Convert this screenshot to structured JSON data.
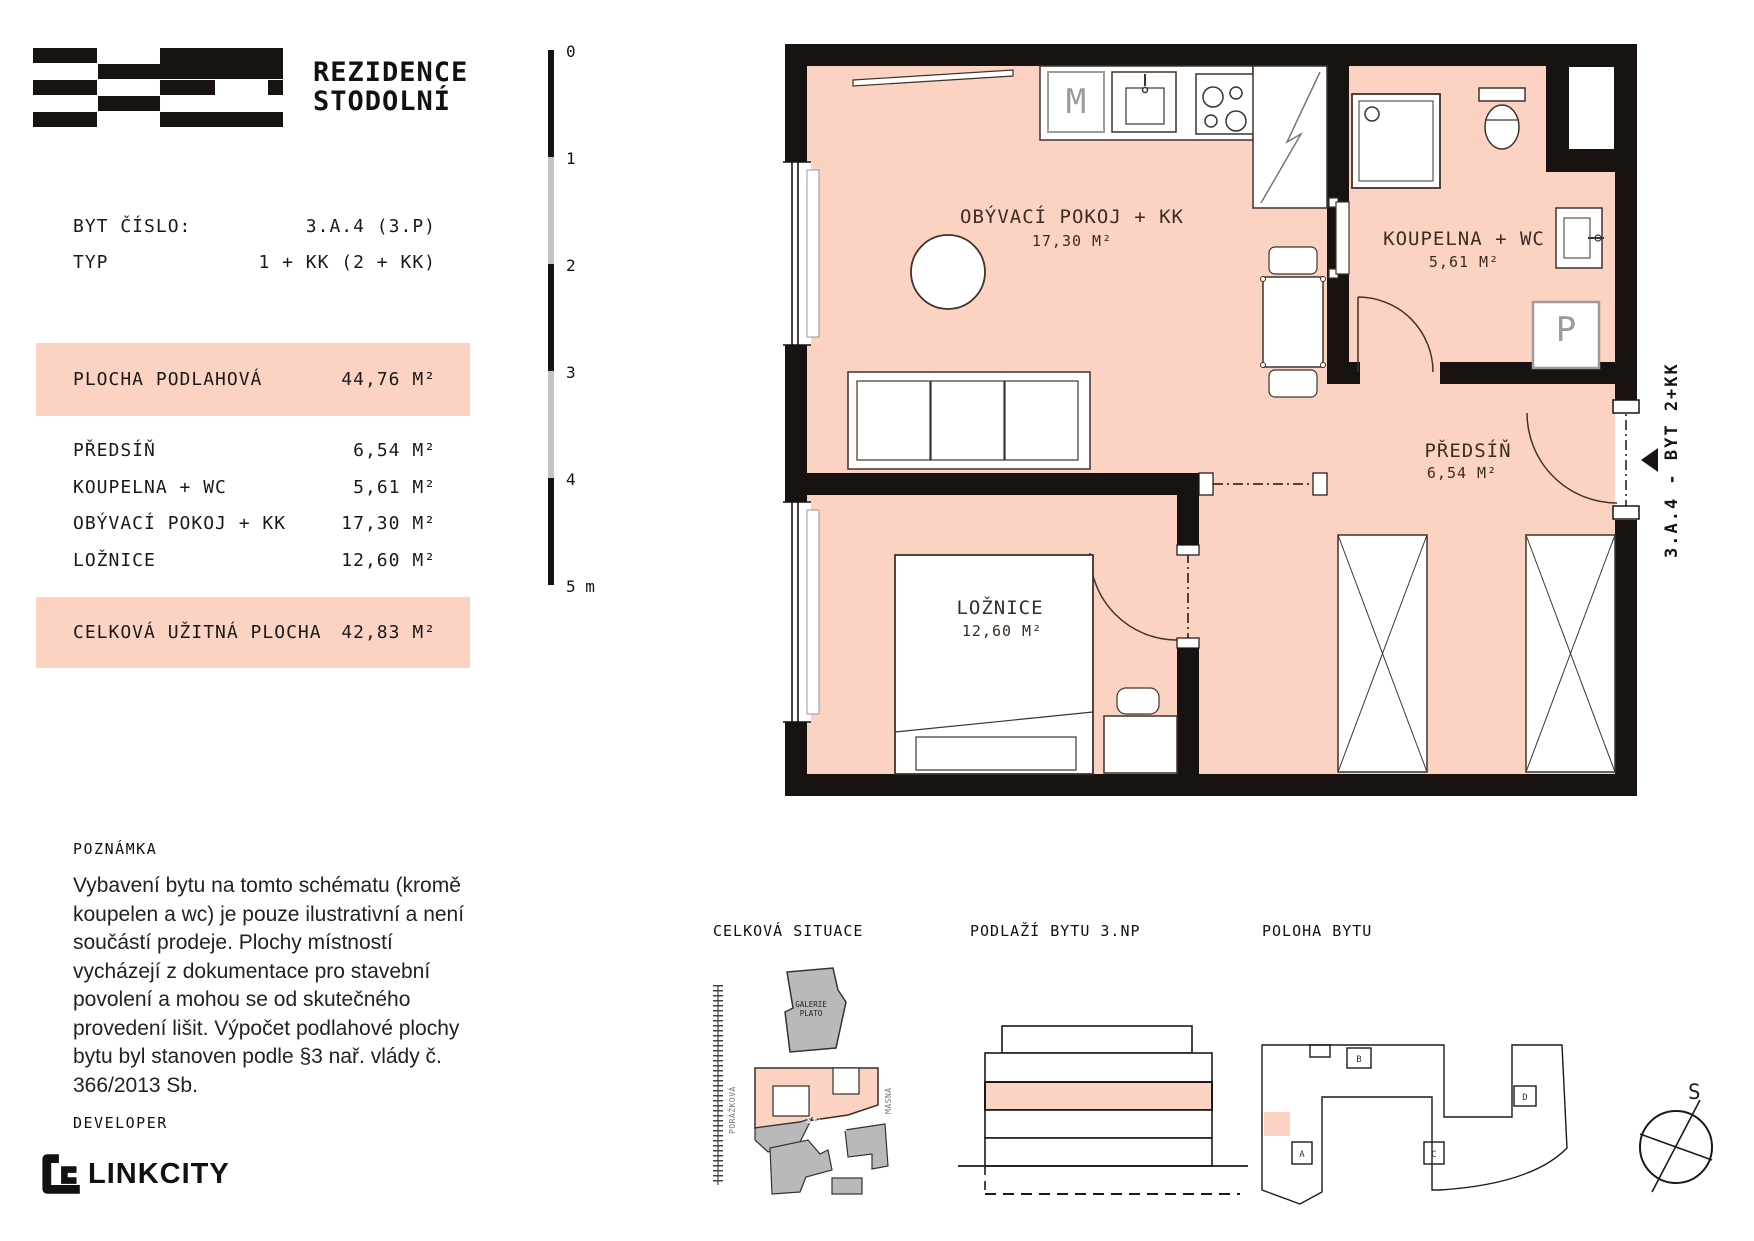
{
  "header": {
    "title_line1": "REZIDENCE",
    "title_line2": "STODOLNÍ"
  },
  "unit_info": {
    "rows": [
      {
        "label": "BYT ČÍSLO:",
        "value": "3.A.4 (3.P)"
      },
      {
        "label": "TYP",
        "value": "1 + KK (2 + KK)"
      }
    ]
  },
  "area_table": {
    "highlight_row": {
      "label": "PLOCHA PODLAHOVÁ",
      "value": "44,76 M²"
    },
    "rows": [
      {
        "label": "PŘEDSÍŇ",
        "value": "6,54 M²"
      },
      {
        "label": "KOUPELNA + WC",
        "value": "5,61 M²"
      },
      {
        "label": "OBÝVACÍ POKOJ + KK",
        "value": "17,30 M²"
      },
      {
        "label": "LOŽNICE",
        "value": "12,60 M²"
      }
    ],
    "total_row": {
      "label": "CELKOVÁ UŽITNÁ PLOCHA",
      "value": "42,83 M²"
    }
  },
  "scale_bar": {
    "labels": [
      "0",
      "1",
      "2",
      "3",
      "4"
    ],
    "unit_label": "5 m"
  },
  "note": {
    "heading": "POZNÁMKA",
    "text": "Vybavení bytu na tomto schématu (kromě koupelen a wc) je pouze ilustrativní a není součástí prodeje. Plochy místností vycházejí z dokumentace pro stavební povolení a mohou se od skutečného provedení lišit. Výpočet podlahové plochy bytu byl stanoven podle §3 nař. vlády č. 366/2013 Sb."
  },
  "developer": {
    "label": "DEVELOPER",
    "name": "LINKCITY"
  },
  "floor_plan": {
    "rooms": [
      {
        "name": "OBÝVACÍ POKOJ + KK",
        "area": "17,30 M²"
      },
      {
        "name": "KOUPELNA + WC",
        "area": "5,61 M²"
      },
      {
        "name": "PŘEDSÍŇ",
        "area": "6,54 M²"
      },
      {
        "name": "LOŽNICE",
        "area": "12,60 M²"
      }
    ],
    "labels": {
      "microwave": "M",
      "washer": "P"
    },
    "entry_label": "3.A.4 - BYT 2+KK"
  },
  "diagrams": {
    "situation": {
      "heading": "CELKOVÁ SITUACE",
      "landmark": "GALERIE PLATO",
      "streets": [
        "PORÁŽKOVÁ",
        "STODOLNÍ",
        "MASNÁ"
      ]
    },
    "floor_diagram": {
      "heading": "PODLAŽÍ BYTU 3.NP"
    },
    "position": {
      "heading": "POLOHA BYTU",
      "block_labels": [
        "A",
        "B",
        "C",
        "D"
      ]
    },
    "compass_label": "S"
  },
  "colors": {
    "accent": "#fcd3c2",
    "wall": "#181210",
    "gray": "#b9b9b9"
  }
}
